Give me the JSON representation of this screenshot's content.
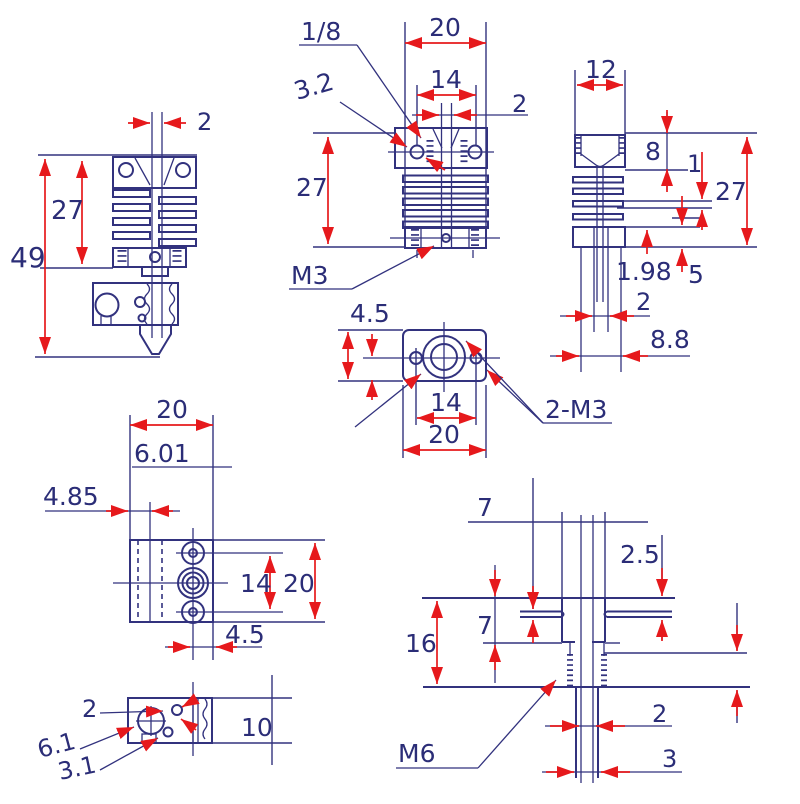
{
  "drawing": {
    "colors": {
      "line": "#32327e",
      "text": "#2b2d77",
      "arrow": "#e6191c",
      "background": "#ffffff"
    },
    "v1": {
      "bore": "2",
      "fins": "27",
      "total": "49"
    },
    "v2": {
      "thread": "1/8",
      "width": "20",
      "spacing": "14",
      "bore": "2",
      "hole": "3.2",
      "height": "27",
      "screw": "M3"
    },
    "v3": {
      "width": "12",
      "cap": "8",
      "fin": "1",
      "height": "27",
      "bore": "1.98",
      "clamp": "5",
      "tube": "2",
      "groove": "8.8"
    },
    "v4": {
      "edge": "4.5",
      "spacing": "14",
      "width": "20",
      "screws": "2-M3"
    },
    "v5": {
      "width": "20",
      "a": "6.01",
      "b": "4.85",
      "spacing": "14",
      "height": "20",
      "c": "4.5"
    },
    "v6": {
      "a": "2",
      "b": "6.1",
      "c": "3.1",
      "height": "10"
    },
    "v7": {
      "top": "7",
      "lip": "2.5",
      "boss": "7",
      "length": "16",
      "id": "2",
      "od": "3",
      "thread": "M6"
    }
  }
}
